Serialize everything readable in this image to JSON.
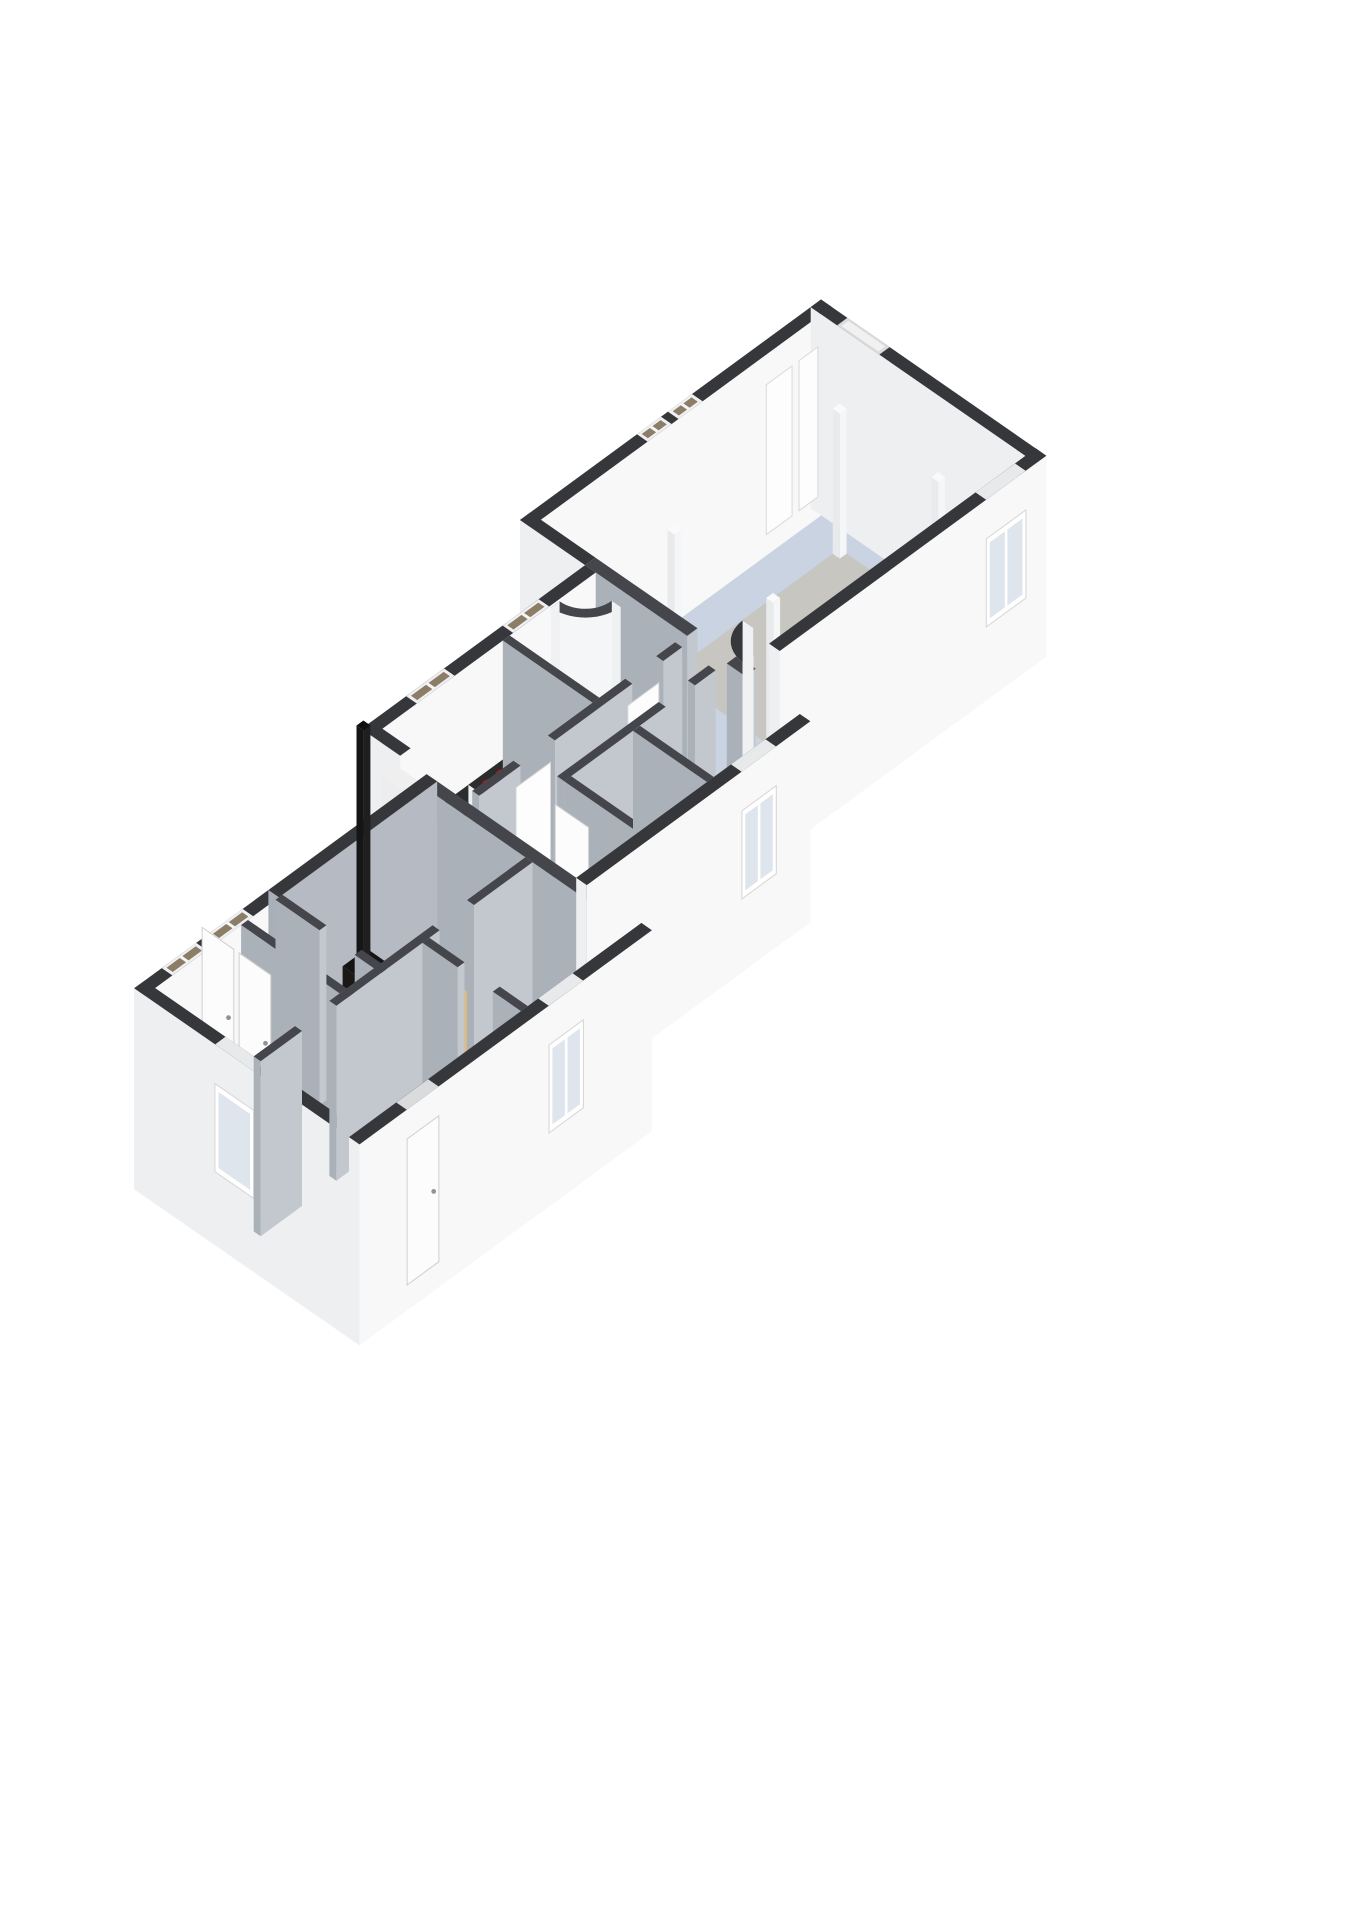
{
  "scene": {
    "title": "isometric-floorplan",
    "background": "#ffffff",
    "projection": {
      "eu": [
        0.86,
        -0.63
      ],
      "ev": [
        0.88,
        0.61
      ],
      "origin": [
        90,
        1010
      ],
      "wall_height": 175,
      "plinth": 26
    },
    "palette": {
      "cap_exterior": "#36373b",
      "cap_interior": "#44464b",
      "face_ext_south": "#f8f8f9",
      "face_ext_west": "#eeeff1",
      "face_int_south": "#c3c7ce",
      "face_int_west": "#abb1b9",
      "face_intx_south": "#b6bbc3",
      "floor_blue": "#c9d3e1",
      "floor_blue_kitchen": "#c3cdda",
      "floor_tan": "#dcba82",
      "floor_hall": "#d9a95e",
      "floor_closet": "#ececec",
      "rug_gray": "#c8c6c1",
      "counter_top": "#2b2c2e",
      "sink_steel": "#c9ced3",
      "burner_red": "#c2231c",
      "stove_black": "#26221f",
      "fire_red": "#6f2012",
      "fire_glow": "#e8772a",
      "pane_north": "#8b7d66",
      "pane_south": "#dfe5ec",
      "fixture_white": "#fbfbfb"
    },
    "block_v_offsets": {
      "E": 0,
      "M": 30,
      "W": 60
    }
  },
  "floors": [
    {
      "name": "great-room-floor",
      "b": "E",
      "r": [
        512,
        12,
        838,
        244
      ],
      "fill": "#c9d3e1"
    },
    {
      "name": "area-rug",
      "b": "E",
      "r": [
        600,
        70,
        800,
        190
      ],
      "fill": "#c8c6c1"
    },
    {
      "name": "kitchen-floor",
      "b": "M",
      "r": [
        252,
        56,
        392,
        158
      ],
      "fill": "#c3cdda"
    },
    {
      "name": "bathroom-floor",
      "b": "M",
      "r": [
        400,
        56,
        488,
        158
      ],
      "fill": "#c9d3e1"
    },
    {
      "name": "hallway-floor",
      "b": "M",
      "r": [
        252,
        166,
        488,
        196
      ],
      "fill": "#d9a95e"
    },
    {
      "name": "hallway-south-floor",
      "b": "M",
      "r": [
        252,
        196,
        312,
        288
      ],
      "fill": "#d9a95e"
    },
    {
      "name": "storage-closet-floor",
      "b": "M",
      "r": [
        320,
        204,
        392,
        288
      ],
      "fill": "#ececec"
    },
    {
      "name": "room-southeast-floor",
      "b": "M",
      "r": [
        400,
        204,
        488,
        288
      ],
      "fill": "#dcba82"
    },
    {
      "name": "bedroom-nw-floor",
      "b": "W",
      "r": [
        -88,
        100,
        52,
        212
      ],
      "fill": "#dcba82"
    },
    {
      "name": "stove-room-floor",
      "b": "W",
      "r": [
        60,
        100,
        228,
        212
      ],
      "fill": "#dcba82"
    },
    {
      "name": "bedroom-sw-floor",
      "b": "W",
      "r": [
        -88,
        220,
        100,
        332
      ],
      "fill": "#dcba82"
    },
    {
      "name": "room-south-floor",
      "b": "W",
      "r": [
        108,
        220,
        228,
        332
      ],
      "fill": "#dcba82"
    }
  ],
  "solids": [
    {
      "name": "wall-great-north",
      "t": "wall",
      "b": "E",
      "k": "ext",
      "r": [
        500,
        0,
        850,
        12
      ],
      "feat": [
        {
          "f": "capwin",
          "a": 636,
          "b": 664
        },
        {
          "f": "capwin",
          "a": 672,
          "b": 700
        }
      ]
    },
    {
      "name": "wall-great-east",
      "t": "wall",
      "b": "E",
      "k": "ext",
      "r": [
        838,
        0,
        850,
        256
      ],
      "feat": [
        {
          "f": "capdoor",
          "a": 30,
          "b": 78
        }
      ]
    },
    {
      "name": "wall-great-west-stub",
      "t": "wall",
      "b": "E",
      "k": "ext",
      "r": [
        500,
        0,
        512,
        74
      ]
    },
    {
      "name": "door-panel-1",
      "t": "leaf",
      "b": "E",
      "p": [
        770,
        16,
        800,
        16
      ],
      "h": 150
    },
    {
      "name": "door-panel-2",
      "t": "leaf",
      "b": "E",
      "p": [
        808,
        16,
        830,
        16
      ],
      "h": 150
    },
    {
      "name": "post-1",
      "t": "prism",
      "b": "E",
      "r": [
        600,
        70,
        608,
        78
      ],
      "h": 145,
      "body": "#f5f6f7",
      "body2": "#e8eaec",
      "top": "#fafafa"
    },
    {
      "name": "post-2",
      "t": "prism",
      "b": "E",
      "r": [
        792,
        70,
        800,
        78
      ],
      "h": 145,
      "body": "#f5f6f7",
      "body2": "#e8eaec",
      "top": "#fafafa"
    },
    {
      "name": "post-3",
      "t": "prism",
      "b": "E",
      "r": [
        600,
        182,
        608,
        190
      ],
      "h": 145,
      "body": "#f5f6f7",
      "body2": "#e8eaec",
      "top": "#fafafa"
    },
    {
      "name": "post-4",
      "t": "prism",
      "b": "E",
      "r": [
        792,
        182,
        800,
        190
      ],
      "h": 145,
      "body": "#f5f6f7",
      "body2": "#e8eaec",
      "top": "#fafafa"
    },
    {
      "name": "wall-great-west-a",
      "t": "wall",
      "b": "E",
      "k": "int",
      "r": [
        500,
        74,
        512,
        190
      ]
    },
    {
      "name": "wall-great-west-b",
      "t": "wall",
      "b": "E",
      "k": "int",
      "r": [
        500,
        235,
        512,
        256
      ]
    },
    {
      "name": "entry-curved-wall",
      "t": "curve",
      "b": "E",
      "c": [
        544,
        244
      ],
      "r0": 34,
      "r1": 22,
      "a0": 180,
      "a1": 270,
      "face": "#f7f8f9",
      "capc": "#36373b"
    },
    {
      "name": "wall-great-south",
      "t": "wall",
      "b": "E",
      "k": "ext",
      "r": [
        540,
        244,
        850,
        256
      ],
      "feat": [
        {
          "f": "win",
          "a": 780,
          "b": 826
        }
      ]
    },
    {
      "name": "wall-mid-north",
      "t": "wall",
      "b": "M",
      "k": "ext",
      "r": [
        240,
        44,
        500,
        56
      ],
      "feat": [
        {
          "f": "capwin",
          "a": 292,
          "b": 336
        },
        {
          "f": "capwin",
          "a": 404,
          "b": 446
        }
      ]
    },
    {
      "name": "wall-mid-west-stub",
      "t": "wall",
      "b": "M",
      "k": "ext",
      "r": [
        240,
        44,
        252,
        88
      ]
    },
    {
      "name": "refrigerator-cabinet",
      "t": "prism",
      "b": "M",
      "r": [
        252,
        56,
        268,
        92
      ],
      "h": 128,
      "body": "#fbfbfb",
      "body2": "#ededef",
      "top": "#efefef"
    },
    {
      "name": "kitchen-counter",
      "t": "prism",
      "b": "M",
      "r": [
        270,
        56,
        352,
        80
      ],
      "h": 56,
      "body": "#fcfcfc",
      "body2": "#eeeff1",
      "top": "#2b2c2e",
      "deco": "sink",
      "dr": [
        294,
        60,
        330,
        76
      ]
    },
    {
      "name": "cooktop-island",
      "t": "prism",
      "b": "M",
      "r": [
        352,
        56,
        392,
        98
      ],
      "h": 56,
      "body": "#fcfcfc",
      "body2": "#eeeff1",
      "top": "#2b2c2e",
      "deco": "burners",
      "pts": [
        [
          364,
          68
        ],
        [
          380,
          68
        ],
        [
          364,
          86
        ],
        [
          380,
          86
        ]
      ],
      "rr": 6
    },
    {
      "name": "bathroom-sink-counter",
      "t": "prism",
      "b": "M",
      "r": [
        402,
        56,
        448,
        78
      ],
      "h": 50,
      "body": "#fbfbfb",
      "body2": "#ededef",
      "top": "#2b2c2e",
      "deco": "basin",
      "ctr": [
        425,
        67
      ],
      "rr": 12
    },
    {
      "name": "shower-curved-wall",
      "t": "curve",
      "b": "M",
      "c": [
        486,
        58
      ],
      "r0": 40,
      "r1": 30,
      "a0": 90,
      "a1": 180,
      "face": "#f5f6f8",
      "capc": "#44464b"
    },
    {
      "name": "wall-kitchen-bath",
      "t": "wall",
      "b": "M",
      "k": "int",
      "r": [
        392,
        56,
        400,
        158
      ]
    },
    {
      "name": "toilet",
      "t": "prism",
      "b": "M",
      "r": [
        474,
        118,
        488,
        146
      ],
      "h": 42,
      "body": "#fafafa",
      "body2": "#ececee",
      "top": "#eeeeee",
      "deco": "bowl",
      "ctr": [
        466,
        132
      ],
      "rr": 12
    },
    {
      "name": "wall-hall-north-a",
      "t": "wall",
      "b": "M",
      "k": "int",
      "r": [
        252,
        158,
        300,
        166
      ]
    },
    {
      "name": "wall-hall-north-b",
      "t": "wall",
      "b": "M",
      "k": "int",
      "r": [
        340,
        158,
        430,
        166
      ]
    },
    {
      "name": "wall-hall-north-c",
      "t": "wall",
      "b": "M",
      "k": "int",
      "r": [
        466,
        158,
        488,
        166
      ]
    },
    {
      "name": "kitchen-door-leaf",
      "t": "leaf",
      "b": "M",
      "p": [
        300,
        161,
        340,
        161
      ],
      "h": 150
    },
    {
      "name": "bathroom-door-leaf",
      "t": "leaf",
      "b": "M",
      "p": [
        430,
        161,
        466,
        161
      ],
      "h": 150
    },
    {
      "name": "wall-hall-south-a",
      "t": "wall",
      "b": "M",
      "k": "int",
      "r": [
        312,
        196,
        430,
        204
      ]
    },
    {
      "name": "wall-hall-south-b",
      "t": "wall",
      "b": "M",
      "k": "int",
      "r": [
        464,
        196,
        488,
        204
      ]
    },
    {
      "name": "wall-closet-west",
      "t": "wall",
      "b": "M",
      "k": "int",
      "r": [
        312,
        204,
        320,
        288
      ],
      "feat": [
        {
          "f": "doorw",
          "a": 224,
          "b": 262
        }
      ]
    },
    {
      "name": "wall-closet-east",
      "t": "wall",
      "b": "M",
      "k": "int",
      "r": [
        392,
        204,
        400,
        288
      ]
    },
    {
      "name": "wall-west-block-east",
      "t": "wall",
      "b": "W",
      "k": "int",
      "r": [
        228,
        100,
        240,
        332
      ]
    },
    {
      "name": "wall-mid-south",
      "t": "wall",
      "b": "M",
      "k": "ext",
      "r": [
        240,
        288,
        500,
        300
      ],
      "feat": [
        {
          "f": "win",
          "a": 420,
          "b": 460
        }
      ]
    },
    {
      "name": "wall-west-north-a",
      "t": "wall",
      "b": "W",
      "k": "ext",
      "r": [
        -100,
        88,
        56,
        100
      ],
      "feat": [
        {
          "f": "capwin",
          "a": -68,
          "b": -28
        },
        {
          "f": "capwin",
          "a": -14,
          "b": 26
        }
      ]
    },
    {
      "name": "wall-west-north-b",
      "t": "wall",
      "b": "W",
      "k": "intx",
      "r": [
        56,
        88,
        240,
        100
      ]
    },
    {
      "name": "wood-stove",
      "t": "prism",
      "b": "W",
      "r": [
        128,
        102,
        156,
        124
      ],
      "h": 62,
      "body": "#26221f",
      "body2": "#1b1816",
      "top": "#141414",
      "deco": "fire"
    },
    {
      "name": "stove-chimney",
      "t": "prism",
      "b": "W",
      "r": [
        138,
        108,
        146,
        116
      ],
      "z0": 62,
      "h": 238,
      "body": "#1f1f1f",
      "body2": "#151515",
      "top": "#0f0f0f"
    },
    {
      "name": "wall-closet-bedroom-nw",
      "t": "wall",
      "b": "W",
      "k": "int",
      "r": [
        12,
        100,
        20,
        212
      ],
      "feat": [
        {
          "f": "doorw",
          "a": 116,
          "b": 152
        },
        {
          "f": "doorw",
          "a": 158,
          "b": 194
        }
      ]
    },
    {
      "name": "wall-bednw-stove-a",
      "t": "wall",
      "b": "W",
      "k": "int",
      "r": [
        52,
        100,
        60,
        150
      ]
    },
    {
      "name": "wall-bednw-stove-b",
      "t": "wall",
      "b": "W",
      "k": "int",
      "r": [
        52,
        190,
        60,
        212
      ]
    },
    {
      "name": "wall-west-exterior",
      "t": "wall",
      "b": "W",
      "k": "ext",
      "r": [
        -100,
        88,
        -88,
        344
      ],
      "feat": [
        {
          "f": "winw",
          "a": 240,
          "b": 284
        }
      ]
    },
    {
      "name": "wall-west-mid-a",
      "t": "wall",
      "b": "W",
      "k": "int",
      "r": [
        -88,
        212,
        -40,
        220
      ]
    },
    {
      "name": "wall-west-mid-b",
      "t": "wall",
      "b": "W",
      "k": "int",
      "r": [
        0,
        212,
        120,
        220
      ]
    },
    {
      "name": "wall-west-mid-c",
      "t": "wall",
      "b": "W",
      "k": "int",
      "r": [
        160,
        212,
        228,
        220
      ]
    },
    {
      "name": "wall-sw-se-a",
      "t": "wall",
      "b": "W",
      "k": "int",
      "r": [
        100,
        220,
        108,
        260
      ]
    },
    {
      "name": "wall-sw-se-b",
      "t": "wall",
      "b": "W",
      "k": "int",
      "r": [
        100,
        300,
        108,
        332
      ]
    },
    {
      "name": "wall-west-south",
      "t": "wall",
      "b": "W",
      "k": "ext",
      "r": [
        -100,
        332,
        240,
        344
      ],
      "feat": [
        {
          "f": "door",
          "a": -45,
          "b": -8
        },
        {
          "f": "win",
          "a": 120,
          "b": 160
        }
      ]
    }
  ]
}
